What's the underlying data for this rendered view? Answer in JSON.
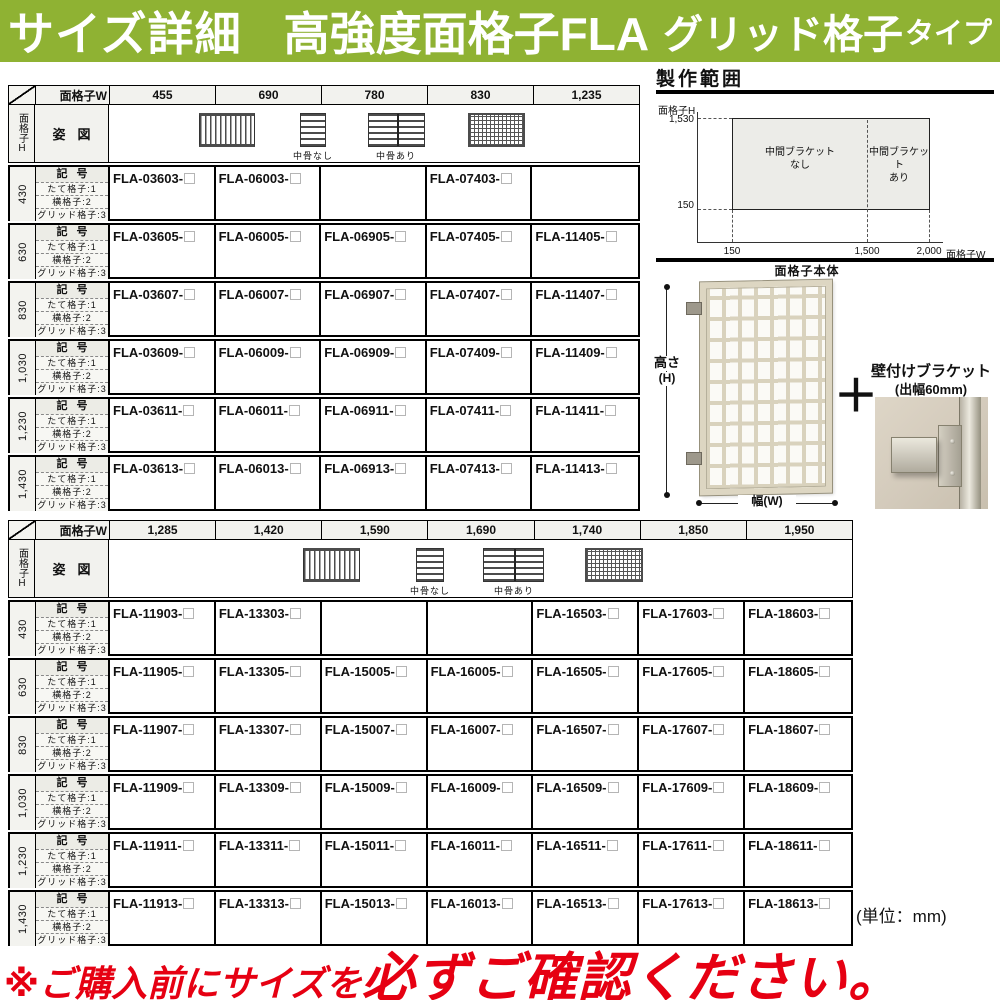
{
  "colors": {
    "banner_green": "#8fb233",
    "warning_red": "#e60012"
  },
  "banner": {
    "t1": "サイズ詳細",
    "t2": "高強度面格子FLA",
    "t3": "グリッド格子",
    "t4": "タイプ"
  },
  "labels": {
    "corner_w": "面格子W",
    "corner_h": "面格子H",
    "sugata": "姿図",
    "kigo": "記号",
    "types": [
      "たて格子:1",
      "横格子:2",
      "グリッド格子:3"
    ]
  },
  "legend": {
    "nashi": "中骨なし",
    "ari": "中骨あり"
  },
  "t1": {
    "w": [
      "455",
      "690",
      "780",
      "830",
      "1,235"
    ],
    "rows": [
      {
        "h": "430",
        "c": [
          "FLA-03603-",
          "FLA-06003-",
          "",
          "FLA-07403-",
          ""
        ]
      },
      {
        "h": "630",
        "c": [
          "FLA-03605-",
          "FLA-06005-",
          "FLA-06905-",
          "FLA-07405-",
          "FLA-11405-"
        ]
      },
      {
        "h": "830",
        "c": [
          "FLA-03607-",
          "FLA-06007-",
          "FLA-06907-",
          "FLA-07407-",
          "FLA-11407-"
        ]
      },
      {
        "h": "1,030",
        "c": [
          "FLA-03609-",
          "FLA-06009-",
          "FLA-06909-",
          "FLA-07409-",
          "FLA-11409-"
        ]
      },
      {
        "h": "1,230",
        "c": [
          "FLA-03611-",
          "FLA-06011-",
          "FLA-06911-",
          "FLA-07411-",
          "FLA-11411-"
        ]
      },
      {
        "h": "1,430",
        "c": [
          "FLA-03613-",
          "FLA-06013-",
          "FLA-06913-",
          "FLA-07413-",
          "FLA-11413-"
        ]
      }
    ]
  },
  "t2": {
    "w": [
      "1,285",
      "1,420",
      "1,590",
      "1,690",
      "1,740",
      "1,850",
      "1,950"
    ],
    "rows": [
      {
        "h": "430",
        "c": [
          "FLA-11903-",
          "FLA-13303-",
          "",
          "",
          "FLA-16503-",
          "FLA-17603-",
          "FLA-18603-"
        ]
      },
      {
        "h": "630",
        "c": [
          "FLA-11905-",
          "FLA-13305-",
          "FLA-15005-",
          "FLA-16005-",
          "FLA-16505-",
          "FLA-17605-",
          "FLA-18605-"
        ]
      },
      {
        "h": "830",
        "c": [
          "FLA-11907-",
          "FLA-13307-",
          "FLA-15007-",
          "FLA-16007-",
          "FLA-16507-",
          "FLA-17607-",
          "FLA-18607-"
        ]
      },
      {
        "h": "1,030",
        "c": [
          "FLA-11909-",
          "FLA-13309-",
          "FLA-15009-",
          "FLA-16009-",
          "FLA-16509-",
          "FLA-17609-",
          "FLA-18609-"
        ]
      },
      {
        "h": "1,230",
        "c": [
          "FLA-11911-",
          "FLA-13311-",
          "FLA-15011-",
          "FLA-16011-",
          "FLA-16511-",
          "FLA-17611-",
          "FLA-18611-"
        ]
      },
      {
        "h": "1,430",
        "c": [
          "FLA-11913-",
          "FLA-13313-",
          "FLA-15013-",
          "FLA-16013-",
          "FLA-16513-",
          "FLA-17613-",
          "FLA-18613-"
        ]
      }
    ]
  },
  "range_chart": {
    "type": "region",
    "title": "製作範囲",
    "y_axis_label": "面格子H",
    "x_axis_label": "面格子W",
    "y_ticks": [
      "1,530",
      "150"
    ],
    "x_ticks": [
      "150",
      "1,500",
      "2,000"
    ],
    "x_range": [
      150,
      2000
    ],
    "y_range": [
      150,
      1530
    ],
    "divider_x": 1500,
    "zone_left_line1": "中間ブラケット",
    "zone_left_line2": "なし",
    "zone_right_line1": "中間ブラケット",
    "zone_right_line2": "あり"
  },
  "product": {
    "body_label": "面格子本体",
    "height_dim": "高さ",
    "height_dim_sub": "(H)",
    "width_dim": "幅(W)",
    "plus_icon": "＋",
    "bracket_title": "壁付けブラケット",
    "bracket_sub": "(出幅60mm)"
  },
  "footer": {
    "unit": "(単位：mm)",
    "warn_prefix": "※ご購入前にサイズを",
    "warn_main": "必ずご確認ください。"
  }
}
